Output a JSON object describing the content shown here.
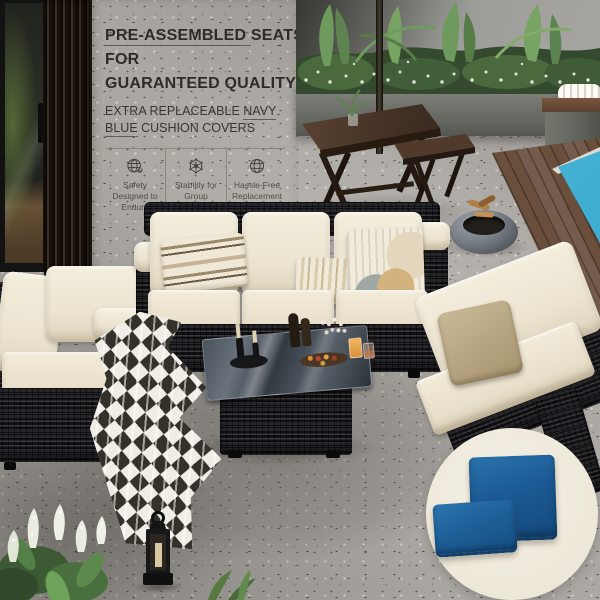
{
  "panel": {
    "headline": {
      "line1_underlined": "PRE-ASSEMBLED",
      "line1_rest": " SEATS",
      "line2": "FOR",
      "line3": "GUARANTEED QUALITY"
    },
    "subheadline": {
      "pre": "EXTRA REPLACEABLE ",
      "underlined1": "NAVY",
      "underlined2": "BLUE",
      "rest": " CUSHION COVERS"
    },
    "features": [
      {
        "icon": "globe-wrench-icon",
        "label": "Safety Designed to Endure"
      },
      {
        "icon": "molecule-icon",
        "label": "Stability for Group Enjoyment"
      },
      {
        "icon": "globe-icon",
        "label": "Hassle-Free Replacement"
      }
    ]
  },
  "colors": {
    "navy_cushion": "#1B5A94",
    "cream_cushion": "#EFE8D7",
    "wicker_black": "#1B1B1E",
    "pool_water": "#45B4D6",
    "panel_background": "#E9E4D4",
    "headline_text": "#2E2C27",
    "deck_wood": "#6A4F3D",
    "floor_concrete": "#ABA8A3",
    "inset_circle_background": "#F2EDE0"
  }
}
